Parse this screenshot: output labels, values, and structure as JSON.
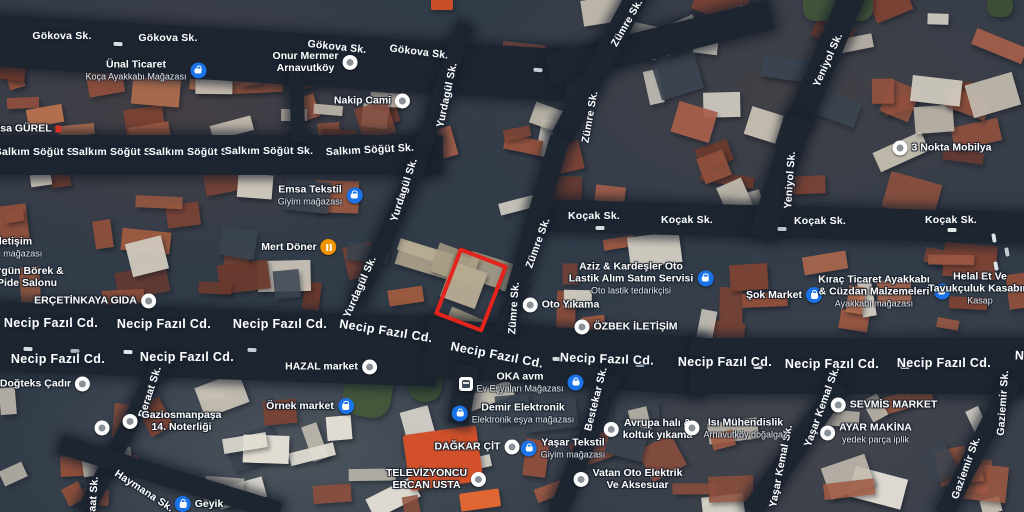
{
  "map": {
    "type": "satellite",
    "colors": {
      "highlight": "#e3241d",
      "street_label": "#ffffff",
      "poi_blue": "#1a73e8",
      "poi_orange": "#f09300",
      "poi_white": "#fdfdfd"
    },
    "highlight_box": {
      "x": 471,
      "y": 290,
      "w": 44,
      "h": 64,
      "rot": 21
    },
    "street_labels": [
      {
        "t": "Gökova Sk.",
        "x": 62,
        "y": 36,
        "r": 0
      },
      {
        "t": "Gökova Sk.",
        "x": 168,
        "y": 38,
        "r": 0
      },
      {
        "t": "Gökova Sk.",
        "x": 337,
        "y": 47,
        "r": 6
      },
      {
        "t": "Gökova Sk.",
        "x": 419,
        "y": 52,
        "r": 7
      },
      {
        "t": "Salkım Söğüt Sk.",
        "x": 39,
        "y": 152,
        "r": 0
      },
      {
        "t": "Salkım Söğüt Sk.",
        "x": 116,
        "y": 152,
        "r": 0
      },
      {
        "t": "Salkım Söğüt Sk.",
        "x": 193,
        "y": 152,
        "r": 0
      },
      {
        "t": "Salkım Söğüt Sk.",
        "x": 269,
        "y": 151,
        "r": 0
      },
      {
        "t": "Salkım Söğüt Sk.",
        "x": 370,
        "y": 150,
        "r": -3
      },
      {
        "t": "Yurdagül Sk.",
        "x": 447,
        "y": 95,
        "r": -78
      },
      {
        "t": "Yurdagül Sk.",
        "x": 404,
        "y": 190,
        "r": -72
      },
      {
        "t": "Yurdagül Sk.",
        "x": 360,
        "y": 287,
        "r": -66
      },
      {
        "t": "Zümre Sk.",
        "x": 627,
        "y": 23,
        "r": -60
      },
      {
        "t": "Zümre Sk.",
        "x": 590,
        "y": 117,
        "r": -80
      },
      {
        "t": "Zümre Sk.",
        "x": 538,
        "y": 243,
        "r": -70
      },
      {
        "t": "Zümre Sk.",
        "x": 514,
        "y": 308,
        "r": -86
      },
      {
        "t": "Yeniyol Sk.",
        "x": 828,
        "y": 60,
        "r": -66
      },
      {
        "t": "Yeniyol Sk.",
        "x": 790,
        "y": 180,
        "r": -86
      },
      {
        "t": "Koçak Sk.",
        "x": 594,
        "y": 216,
        "r": 0
      },
      {
        "t": "Koçak Sk.",
        "x": 687,
        "y": 220,
        "r": 0
      },
      {
        "t": "Koçak Sk.",
        "x": 820,
        "y": 221,
        "r": 0
      },
      {
        "t": "Koçak Sk.",
        "x": 951,
        "y": 220,
        "r": 0
      },
      {
        "t": "Necip Fazıl Cd.",
        "x": 51,
        "y": 323,
        "r": 0,
        "big": true
      },
      {
        "t": "Necip Fazıl Cd.",
        "x": 164,
        "y": 324,
        "r": 0,
        "big": true
      },
      {
        "t": "Necip Fazıl Cd.",
        "x": 280,
        "y": 324,
        "r": 0,
        "big": true
      },
      {
        "t": "Necip Fazıl Cd.",
        "x": 386,
        "y": 331,
        "r": 9,
        "big": true
      },
      {
        "t": "Necip Fazıl Cd.",
        "x": 58,
        "y": 359,
        "r": 0,
        "big": true
      },
      {
        "t": "Necip Fazıl Cd.",
        "x": 187,
        "y": 357,
        "r": 0,
        "big": true
      },
      {
        "t": "Necip Fazıl Cd.",
        "x": 497,
        "y": 355,
        "r": 11,
        "big": true
      },
      {
        "t": "Necip Fazıl Cd.",
        "x": 607,
        "y": 359,
        "r": 2,
        "big": true
      },
      {
        "t": "Necip Fazıl Cd.",
        "x": 725,
        "y": 362,
        "r": 0,
        "big": true
      },
      {
        "t": "Necip Fazıl Cd.",
        "x": 832,
        "y": 364,
        "r": 0,
        "big": true
      },
      {
        "t": "Necip Fazıl Cd.",
        "x": 944,
        "y": 363,
        "r": 0,
        "big": true
      },
      {
        "t": "Necip Fazıl Cd.",
        "x": 1062,
        "y": 357,
        "r": 2,
        "big": true
      },
      {
        "t": "Bestekar Sk.",
        "x": 596,
        "y": 399,
        "r": -76
      },
      {
        "t": "Yaşar Kemal Sk.",
        "x": 822,
        "y": 407,
        "r": -70
      },
      {
        "t": "Yaşar Kemal Sk.",
        "x": 781,
        "y": 466,
        "r": -79
      },
      {
        "t": "Gaziemir Sk.",
        "x": 1003,
        "y": 403,
        "r": -86
      },
      {
        "t": "Gaziemir Sk.",
        "x": 966,
        "y": 468,
        "r": -70
      },
      {
        "t": "Beraat Sk.",
        "x": 150,
        "y": 392,
        "r": -72
      },
      {
        "t": "Beraat Sk.",
        "x": 93,
        "y": 503,
        "r": -86
      },
      {
        "t": "Haymana Sk.",
        "x": 144,
        "y": 491,
        "r": 33
      }
    ],
    "places": [
      {
        "lines": [
          "Ünal Ticaret"
        ],
        "sub": "Koça Ayakkabı Mağazası",
        "icon": "blue",
        "icon_name": "shopping-bag-icon",
        "side": "right",
        "x": 146,
        "y": 70
      },
      {
        "lines": [
          "Onur Mermer",
          "Arnavutköy"
        ],
        "icon": "white",
        "icon_name": "poi-icon",
        "side": "right",
        "x": 315,
        "y": 62
      },
      {
        "lines": [
          "Nakip Cami"
        ],
        "icon": "white",
        "icon_name": "mosque-icon",
        "side": "right",
        "x": 372,
        "y": 101
      },
      {
        "lines": [
          "Isa GÜREL"
        ],
        "icon": "white",
        "icon_name": "poi-icon",
        "side": "left",
        "trail": "red",
        "x": 20,
        "y": 129
      },
      {
        "lines": [
          "İletişim"
        ],
        "sub": "onu mağazası",
        "icon": "none",
        "side": "none",
        "x": 14,
        "y": 247
      },
      {
        "lines": [
          "Emsa Tekstil"
        ],
        "sub": "Giyim mağazası",
        "icon": "blue",
        "icon_name": "shopping-bag-icon",
        "side": "right",
        "x": 320,
        "y": 195
      },
      {
        "lines": [
          "Mert Döner"
        ],
        "icon": "orange",
        "icon_name": "restaurant-icon",
        "side": "right",
        "x": 299,
        "y": 247
      },
      {
        "lines": [
          "3 Nokta Mobilya"
        ],
        "icon": "white",
        "icon_name": "poi-icon",
        "side": "left",
        "x": 942,
        "y": 148
      },
      {
        "lines": [
          "Ergün Börek &",
          "Pide Salonu"
        ],
        "icon": "none",
        "side": "none",
        "x": 27,
        "y": 277
      },
      {
        "lines": [
          "ERÇETİNKAYA GIDA"
        ],
        "icon": "white",
        "icon_name": "poi-icon",
        "side": "right",
        "x": 95,
        "y": 301
      },
      {
        "lines": [
          "Doğteks Çadır"
        ],
        "icon": "white",
        "icon_name": "poi-icon",
        "side": "right",
        "x": 45,
        "y": 384
      },
      {
        "lines": [
          "HAZAL market"
        ],
        "icon": "white",
        "icon_name": "grocery-icon",
        "side": "right",
        "x": 331,
        "y": 367
      },
      {
        "lines": [
          "Gaziosmanpaşa",
          "14. Noterliği"
        ],
        "icon": "white",
        "icon_name": "notary-icon",
        "side": "left",
        "x": 172,
        "y": 421
      },
      {
        "lines": [
          "Örnek market"
        ],
        "icon": "blue",
        "icon_name": "cart-icon",
        "side": "right",
        "x": 310,
        "y": 406
      },
      {
        "lines": [],
        "icon": "white",
        "icon_name": "poi-icon",
        "side": "only",
        "x": 102,
        "y": 428
      },
      {
        "lines": [
          "Geyik"
        ],
        "icon": "blue",
        "icon_name": "shopping-bag-icon",
        "side": "left",
        "x": 199,
        "y": 504
      },
      {
        "lines": [
          "TELEVİZYONCU",
          "ERCAN USTA"
        ],
        "icon": "white",
        "icon_name": "repair-icon",
        "side": "right",
        "x": 436,
        "y": 479
      },
      {
        "lines": [
          "DAĞKAR ÇİT"
        ],
        "icon": "white",
        "icon_name": "poi-icon",
        "side": "right",
        "x": 477,
        "y": 447
      },
      {
        "lines": [
          "Demir Elektronik"
        ],
        "sub": "Elektronik eşya mağazası",
        "icon": "blue",
        "icon_name": "shopping-bag-icon",
        "side": "left",
        "x": 513,
        "y": 413
      },
      {
        "lines": [
          "Yaşar Tekstil"
        ],
        "sub": "Giyim mağazası",
        "icon": "blue",
        "icon_name": "shopping-bag-icon",
        "side": "left",
        "x": 563,
        "y": 448
      },
      {
        "lines": [
          "OKA avm"
        ],
        "sub": "Ev Eşyaları Mağazası",
        "icon": "blue",
        "icon_name": "shopping-bag-icon",
        "side": "right",
        "x": 530,
        "y": 382
      },
      {
        "lines": [
          "Oto Yıkama"
        ],
        "icon": "white",
        "icon_name": "car-wash-icon",
        "side": "left",
        "x": 561,
        "y": 305
      },
      {
        "lines": [
          "ÖZBEK İLETİŞİM"
        ],
        "icon": "white",
        "icon_name": "phone-shop-icon",
        "side": "left",
        "x": 626,
        "y": 327
      },
      {
        "lines": [
          "Aziz & Kardeşler Oto",
          "Lastik Alım Satım Servisi"
        ],
        "sub": "Oto lastik tedarikçisi",
        "icon": "blue",
        "icon_name": "shopping-bag-icon",
        "side": "right",
        "x": 641,
        "y": 278
      },
      {
        "lines": [
          "Şok Market"
        ],
        "icon": "blue",
        "icon_name": "cart-icon",
        "side": "right",
        "x": 784,
        "y": 295
      },
      {
        "lines": [
          "Kıraç Ticaret Ayakkabı",
          "& Cüzdan Malzemeleri"
        ],
        "sub": "Ayakkabı mağazası",
        "icon": "blue",
        "icon_name": "shopping-bag-icon",
        "side": "right",
        "x": 884,
        "y": 291
      },
      {
        "lines": [
          "Helal Et Ve",
          "Tavukçuluk Kasabım"
        ],
        "sub": "Kasap",
        "icon": "blue",
        "icon_name": "shopping-bag-icon",
        "side": "right",
        "x": 990,
        "y": 288
      },
      {
        "lines": [
          "SEVMİS MARKET"
        ],
        "icon": "white",
        "icon_name": "cart-icon",
        "side": "left",
        "x": 884,
        "y": 405
      },
      {
        "lines": [
          "AYAR MAKİNA"
        ],
        "sub": "yedek parça iplik",
        "icon": "white",
        "icon_name": "poi-icon",
        "side": "left",
        "x": 866,
        "y": 433
      },
      {
        "lines": [
          "Avrupa halı &",
          "koltuk yıkama"
        ],
        "icon": "white",
        "icon_name": "cleaning-icon",
        "side": "left",
        "x": 648,
        "y": 429
      },
      {
        "lines": [
          "Isı Mühendislik"
        ],
        "sub": "Arnavutköy doğalgaz",
        "icon": "white",
        "icon_name": "engineering-icon",
        "side": "left",
        "x": 736,
        "y": 428
      },
      {
        "lines": [
          "Vatan Oto Elektrik",
          "Ve Aksesuar"
        ],
        "icon": "white",
        "icon_name": "auto-parts-icon",
        "side": "left",
        "x": 628,
        "y": 479
      },
      {
        "lines": [],
        "icon": "bus",
        "icon_name": "bus-station-icon",
        "side": "only",
        "x": 466,
        "y": 384
      }
    ]
  }
}
